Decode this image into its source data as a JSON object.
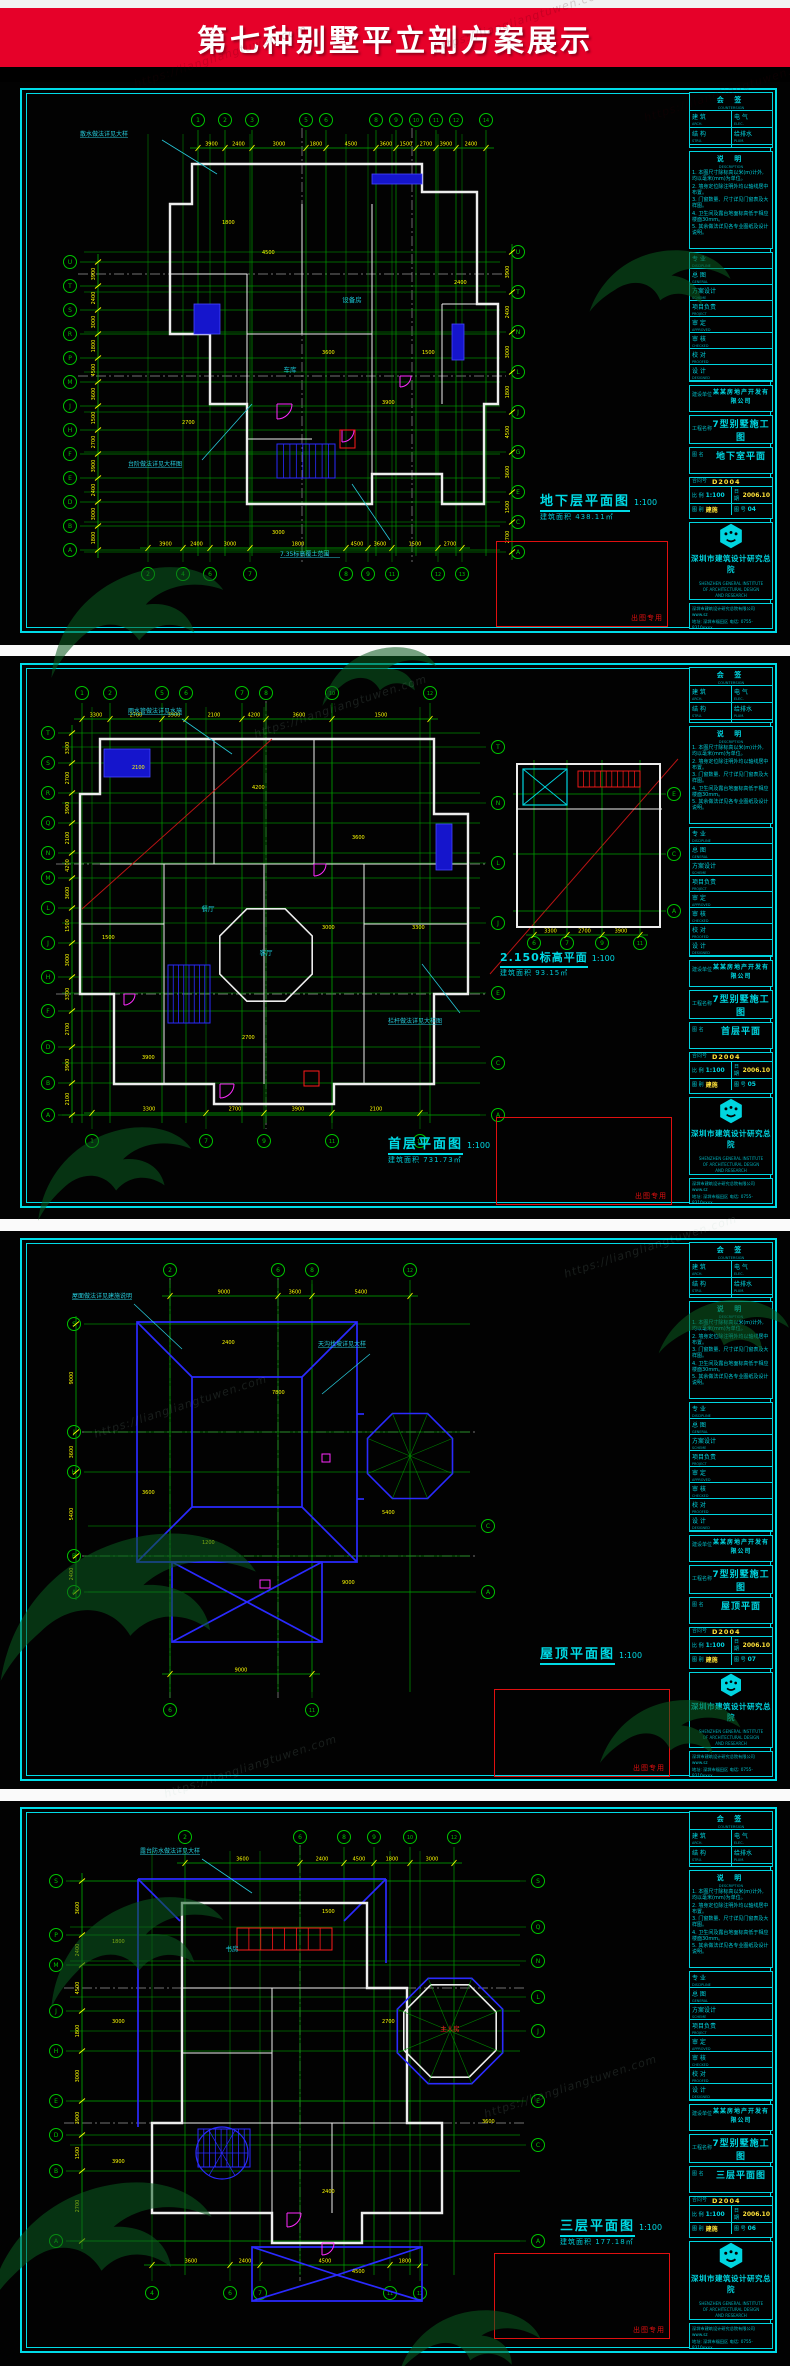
{
  "banner": {
    "title": "第七种别墅平立剖方案展示",
    "bg": "#e60129"
  },
  "watermark": {
    "url_text": "https://liangliangtuwen.com",
    "logo_color": "#0b5c20"
  },
  "colors": {
    "cyan": "#00dce8",
    "green": "#00c400",
    "yellow": "#ffff00",
    "wall": "#ededed",
    "blue": "#2a2aff",
    "magenta": "#ff2bff",
    "red": "#ff1a1a",
    "panel_bg": "#020202"
  },
  "title_block": {
    "sign": {
      "header": "会 签",
      "sub": "COUNTERSIGN",
      "cells": [
        [
          "建 筑",
          "ARCH."
        ],
        [
          "电 气",
          "ELEC."
        ],
        [
          "结 构",
          "STRU."
        ],
        [
          "给排水",
          "PLUM."
        ],
        [
          "暖 通",
          "HVAC"
        ],
        [
          "",
          ""
        ]
      ]
    },
    "notes": {
      "header": "说 明",
      "sub": "DESCRIPTION",
      "items": [
        "1. 本图尺寸除标高以米(m)计外, 均以毫米(mm)为单位。",
        "2. 墙身定位除注明外均以轴线居中布置。",
        "3. 门窗数量、尺寸详见门窗表及大样图。",
        "4. 卫生间及露台地面标高低于相应楼面30mm。",
        "5. 其余做法详见各专业图纸及设计说明。"
      ]
    },
    "personnel": [
      [
        "专 业",
        "DISCIPLINE"
      ],
      [
        "总 图",
        "GENERAL"
      ],
      [
        "方案设计",
        "SCHEME"
      ],
      [
        "项目负责",
        "PROJECT"
      ],
      [
        "审 定",
        "APPROVED"
      ],
      [
        "审 核",
        "CHECKED"
      ],
      [
        "校 对",
        "PROOFED"
      ],
      [
        "设 计",
        "DESIGNED"
      ],
      [
        "制 图",
        "DRAWN"
      ]
    ],
    "owner": {
      "label": "建设单位",
      "value": "某某房地产开发有限公司"
    },
    "project": {
      "label": "工程名称",
      "value": "7型别墅施工图"
    },
    "name_label": "图 名",
    "contract": {
      "label": "合同号",
      "value": "D2004"
    },
    "scale": {
      "label": "比 例",
      "value": "1:100"
    },
    "date": {
      "label": "日 期",
      "value": "2006.10"
    },
    "dtype": {
      "label": "图 别",
      "value": "建施"
    },
    "dno_label": "图 号",
    "company": {
      "name": "深圳市建筑设计研究总院",
      "en": [
        "SHENZHEN GENERAL INSTITUTE",
        "OF ARCHITECTURAL DESIGN",
        "AND RESEARCH"
      ],
      "contact1": "深圳市建筑设计研究总院有限公司  www.sz",
      "contact2": "地址: 深圳市福田区  电话: 0755-8310xxxx"
    },
    "stamp_label": "出图专用"
  },
  "panels": [
    {
      "id": "basement",
      "figure": {
        "title": "地下层平面图",
        "scale": "1:100",
        "area": "建筑面积 438.11㎡"
      },
      "tb_name": "地下室平面",
      "tb_no": "04",
      "axes": {
        "top": [
          "1",
          "2",
          "3",
          "5",
          "6",
          "8",
          "9",
          "10",
          "11",
          "12",
          "14"
        ],
        "left": [
          "U",
          "T",
          "S",
          "R",
          "P",
          "M",
          "J",
          "H",
          "F",
          "E",
          "D",
          "B",
          "A"
        ],
        "right": [
          "U",
          "T",
          "N",
          "L",
          "J",
          "G",
          "E",
          "C",
          "A"
        ],
        "bottom": [
          "2",
          "4",
          "6",
          "7",
          "8",
          "9",
          "11",
          "12",
          "13"
        ]
      },
      "dims": [
        "3900",
        "2400",
        "3000",
        "1800",
        "4500",
        "3600",
        "1500",
        "2700"
      ],
      "leader_notes": [
        "散水做法详见大样",
        "台阶做法详见大样图",
        "7.35标高覆土范围"
      ],
      "rooms": [
        "车库",
        "设备房"
      ]
    },
    {
      "id": "first-floor",
      "figure": {
        "title": "首层平面图",
        "scale": "1:100",
        "area": "建筑面积 731.73㎡"
      },
      "tb_name": "首层平面",
      "tb_no": "05",
      "detail": {
        "title": "2.150标高平面",
        "scale": "1:100",
        "area": "建筑面积 93.15㎡",
        "axes": {
          "right": [
            "E",
            "C",
            "A"
          ],
          "bottom": [
            "6",
            "7",
            "9",
            "11"
          ]
        }
      },
      "axes": {
        "top": [
          "1",
          "2",
          "5",
          "6",
          "7",
          "8",
          "10",
          "12"
        ],
        "left": [
          "T",
          "S",
          "R",
          "Q",
          "N",
          "M",
          "L",
          "J",
          "H",
          "F",
          "D",
          "B",
          "A"
        ],
        "right": [
          "T",
          "N",
          "L",
          "J",
          "E",
          "C",
          "A"
        ],
        "bottom": [
          "1",
          "7",
          "9",
          "11",
          "13"
        ]
      },
      "dims": [
        "3300",
        "2700",
        "3900",
        "2100",
        "4200",
        "3600",
        "1500",
        "3000"
      ],
      "leader_notes": [
        "雨水管做法详见水施",
        "栏杆做法详见大样图"
      ],
      "rooms": [
        "客厅",
        "餐厅"
      ]
    },
    {
      "id": "roof",
      "figure": {
        "title": "屋顶平面图",
        "scale": "1:100",
        "area": ""
      },
      "tb_name": "屋顶平面",
      "tb_no": "07",
      "axes": {
        "top": [
          "2",
          "6",
          "8",
          "12"
        ],
        "left": [
          "S",
          "J",
          "H",
          "B",
          "A"
        ],
        "right": [
          "C",
          "A"
        ],
        "bottom": [
          "6",
          "11"
        ]
      },
      "dims": [
        "9000",
        "3600",
        "5400",
        "2400",
        "7800",
        "1200"
      ],
      "leader_notes": [
        "屋面做法详见建施说明",
        "天沟找坡详见大样"
      ],
      "rooms": []
    },
    {
      "id": "third-floor",
      "figure": {
        "title": "三层平面图",
        "scale": "1:100",
        "area": "建筑面积 177.18㎡"
      },
      "tb_name": "三层平面图",
      "tb_no": "06",
      "axes": {
        "top": [
          "2",
          "6",
          "8",
          "9",
          "10",
          "12"
        ],
        "left": [
          "S",
          "P",
          "M",
          "J",
          "H",
          "E",
          "D",
          "B",
          "A"
        ],
        "right": [
          "S",
          "Q",
          "N",
          "L",
          "J",
          "E",
          "C",
          "A"
        ],
        "bottom": [
          "4",
          "6",
          "7",
          "11",
          "12"
        ]
      },
      "dims": [
        "3600",
        "2400",
        "4500",
        "1800",
        "3000",
        "3900",
        "1500",
        "2700"
      ],
      "leader_notes": [
        "露台防水做法详见大样"
      ],
      "rooms": [
        "主人房",
        "书房"
      ]
    }
  ]
}
